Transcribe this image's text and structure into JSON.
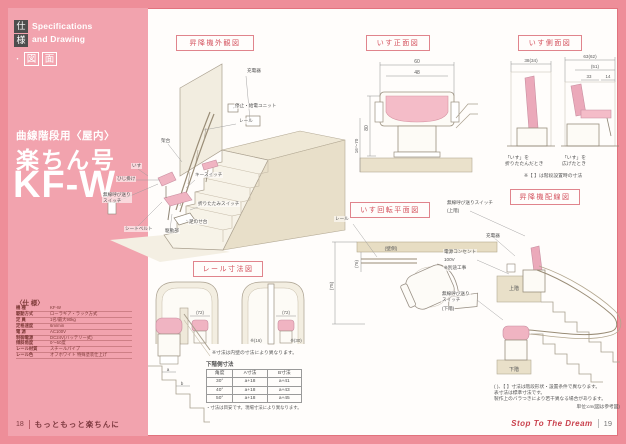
{
  "sidebar": {
    "tab_chars": [
      "仕",
      "様"
    ],
    "tab_en": [
      "Specifications",
      "and Drawing"
    ],
    "tab_dot": "・",
    "tab_boxed": [
      "図",
      "面"
    ],
    "category": "曲線階段用〈屋内〉",
    "product": "楽ちん号",
    "model": "KF-W",
    "spec_title": "〈仕 様〉",
    "spec_rows": [
      {
        "label": "機 種",
        "value": "KF-W"
      },
      {
        "label": "駆動方式",
        "value": "ローラギア・ラック方式"
      },
      {
        "label": "定 員",
        "value": "1名/最大90kg"
      },
      {
        "label": "定格速度",
        "value": "6m/min"
      },
      {
        "label": "電 源",
        "value": "AC100V"
      },
      {
        "label": "制御電源",
        "value": "DC24V(バッテリー式)"
      },
      {
        "label": "傾斜角度",
        "value": "0〜50度"
      },
      {
        "label": "レール材質",
        "value": "スチールパイプ"
      },
      {
        "label": "レール色",
        "value": "オフホワイト 特殊塗装仕上げ"
      }
    ]
  },
  "exterior": {
    "title": "昇降機外観図",
    "labels": {
      "charger": "充電器",
      "feed_unit": "停止・給電ユニット",
      "rail": "レール",
      "frame": "架台",
      "chair": "いす",
      "armrest": "ひじ掛け",
      "key_switch": "キースイッチ",
      "fold_switch": "折りたたみスイッチ",
      "remote": "無線呼び送り\nスイッチ",
      "seatbelt": "シートベルト",
      "drive": "駆動部",
      "footrest": "足のせ台"
    }
  },
  "front": {
    "title": "いす正面図",
    "dim_total_width": "60",
    "dim_seat_width": "48",
    "dim_height": "80",
    "dim_floor": "16〜70"
  },
  "side": {
    "title": "いす側面図",
    "dim_folded": "38(34)",
    "dim_open_total": "63(62)",
    "dim_open_inner": "(51)",
    "dim_seat_depth": "33",
    "dim_front": "14",
    "caption_folded": "「いす」を\n折りたたんだとき",
    "caption_open": "「いす」を\n広げたとき",
    "note": "※【 】は階段設置時の寸法"
  },
  "rail": {
    "title": "レール寸法図",
    "dim_left_width": "(72)",
    "dim_left_bottom": "(16)",
    "dim_right_width": "(72)",
    "dim_right_bottom_a": "※(16)",
    "dim_right_bottom_b": "※(30)",
    "note": "※寸法は内壁の寸法により異なります。",
    "sketch_dim_a": "a",
    "sketch_dim_b": "b",
    "table": {
      "title": "下階側寸法",
      "headers": [
        "角度",
        "A寸法",
        "B寸法"
      ],
      "rows": [
        [
          "30°",
          "a+18",
          "a+41"
        ],
        [
          "40°",
          "a+18",
          "a+43"
        ],
        [
          "50°",
          "a+18",
          "a+45"
        ]
      ],
      "note": "・寸法は目安です。現場寸法により異なります。"
    }
  },
  "rotation": {
    "title": "いす回転平面図",
    "rail_label": "レール",
    "wall_label": "(壁側)",
    "dim_depth": "(75)",
    "dim_rail": "(76)"
  },
  "wiring": {
    "title": "昇降機配線図",
    "switch_upper": "無線呼び送りスイッチ",
    "upper_tag": "(上階)",
    "charger": "充電器",
    "outlet_l1": "電源コンセント",
    "outlet_l2": "100V",
    "outlet_l3": "※別途工事",
    "switch_lower": "無線呼び送り\nスイッチ",
    "lower_tag": "(下階)",
    "floor_upper": "上階",
    "floor_lower": "下階",
    "notes": [
      "( )、【 】寸法は階段形状・設置条件で異なります。",
      "表寸法は標準寸法です。",
      "製作上のバラつきにより若干異なる場合があります。"
    ],
    "unit": "単位:cm(図は参考図)"
  },
  "footer": {
    "left_page": "18",
    "left_text": "もっともっと楽ちんに",
    "right_text": "Stop To The Dream",
    "right_page": "19"
  }
}
